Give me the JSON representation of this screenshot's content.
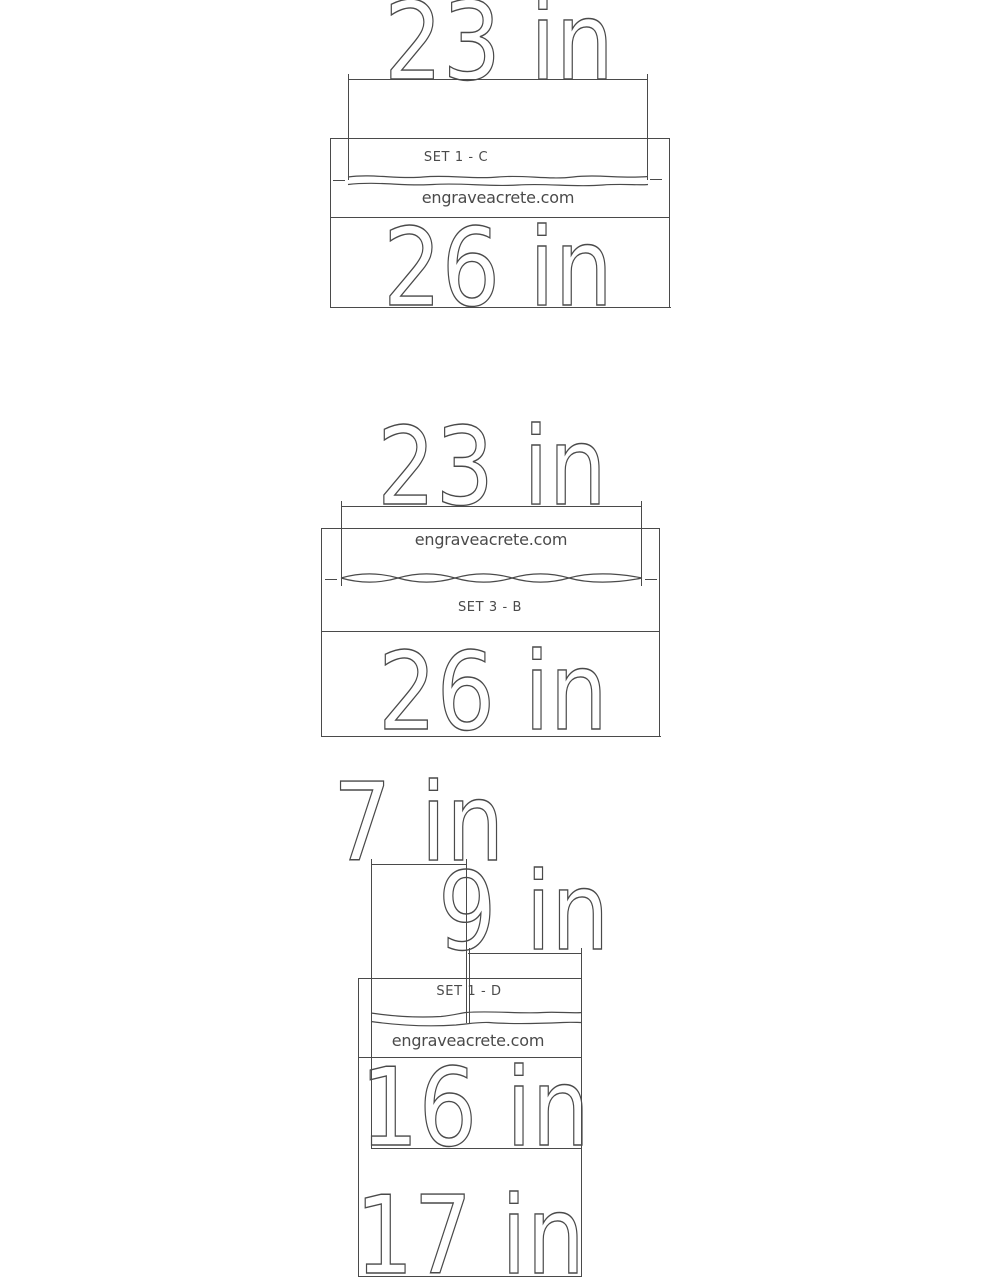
{
  "page": {
    "background": "#ffffff",
    "line_color": "#4a4a4a",
    "description": "Stencil set dimension drawings"
  },
  "figures": [
    {
      "id": "set-1-c",
      "set_label": "SET 1 - C",
      "website": "engraveacrete.com",
      "top_width_label": "23 in",
      "bottom_width_label": "26 in"
    },
    {
      "id": "set-3-b",
      "set_label": "SET 3 - B",
      "website": "engraveacrete.com",
      "top_width_label": "23 in",
      "bottom_width_label": "26 in"
    },
    {
      "id": "set-1-d",
      "set_label": "SET 1 - D",
      "website": "engraveacrete.com",
      "upper_width_label": "7 in",
      "lower_width_label": "9 in",
      "inner_height_label": "16 in",
      "outer_height_label": "17 in"
    }
  ]
}
